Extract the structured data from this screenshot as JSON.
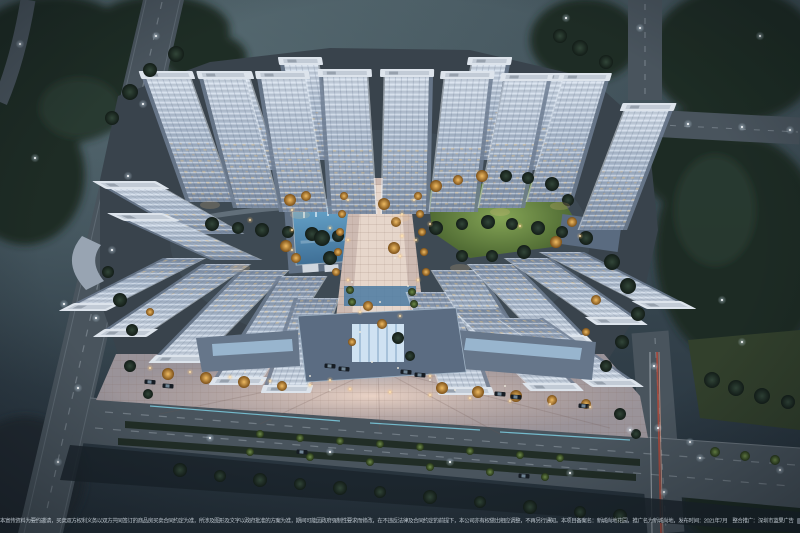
{
  "scene": {
    "subject": "aerial-night-rendering-of-residential-complex"
  },
  "disclaimer": {
    "text": "本宣传资料为要约邀请，买卖双方权利义务以双方共同签订的商品房买卖合同约定为准，所涉及图形及文字以政府批准的方案为准，期间可能因政府强制性要求而修改，在不违反法律及合同约定的前提下，本公司亦有权做出相应调整，不再另行通知。本项目备案名：新城尚地花园，推广名为新城尚地，发布时间：2021年7月　整合推广：深圳市蓝果广告"
  },
  "project": {
    "filing_name": "新城尚地花园",
    "promo_name": "新城尚地",
    "publish_date": "2021年7月"
  },
  "colors": {
    "sky_top": "#46575f",
    "sky_bottom": "#232e37",
    "tree_dark": "#1d2a24",
    "road": "#49545d",
    "tower_light": "#d0dae6",
    "tower_facade": "#a9b8cb",
    "tower_shadow": "#8090a6",
    "tower_roof": "#dde4ec",
    "pool_light": "#65a2c8",
    "pool_dark": "#3f6f96",
    "lawn_light": "#85a556",
    "lawn_dark": "#4f6a33",
    "plaza_base": "#9a9399",
    "plaza_warm": "#eed6c8",
    "skylight": "#cfe2f2",
    "autumn_tree": "#cf8f3e",
    "warm_light": "#ffd98a"
  }
}
